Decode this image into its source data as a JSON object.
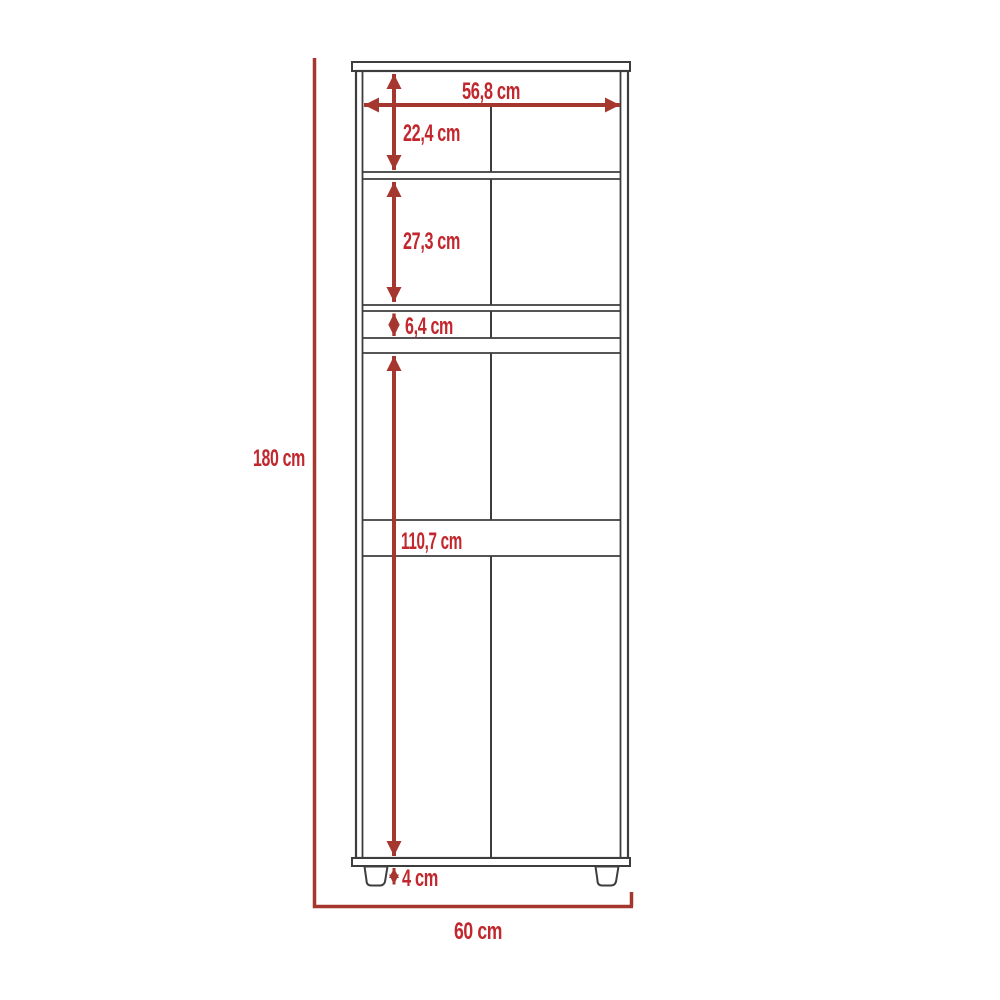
{
  "diagram": {
    "kind": "cabinet-dimension-drawing",
    "unit": "cm",
    "dimensions": {
      "interior_width": "56,8 cm",
      "top_section_height": "22,4 cm",
      "second_section_height": "27,3 cm",
      "drawer_section_height": "6,4 cm",
      "lower_section_height": "110,7 cm",
      "total_height": "180 cm",
      "feet_height": "4 cm",
      "total_width": "60 cm"
    },
    "colors": {
      "dimension_line": "#a5372f",
      "dimension_text": "#c1272d",
      "cabinet_line": "#3d3d3d",
      "background": "#ffffff"
    }
  }
}
